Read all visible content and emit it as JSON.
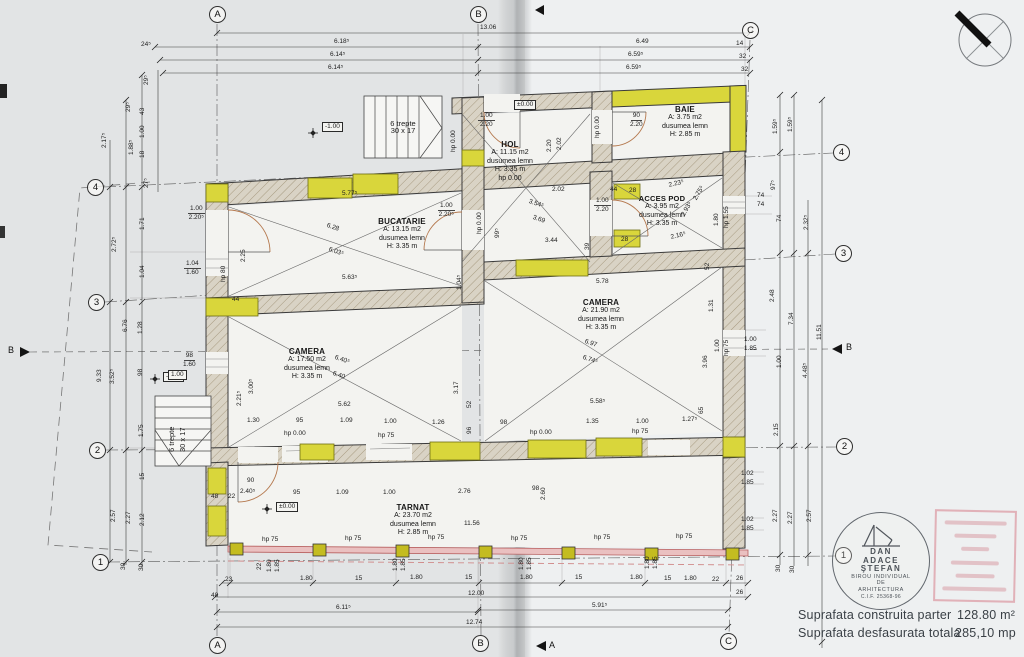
{
  "grid": {
    "a": "A",
    "b": "B",
    "c": "C",
    "n1": "1",
    "n2": "2",
    "n3": "3",
    "n4": "4"
  },
  "sections": {
    "a": "A",
    "b": "B"
  },
  "levels": {
    "minus": "-1.00"
  },
  "stairs": {
    "l1": "6 trepte",
    "l2": "30 x 17"
  },
  "rooms": {
    "bucatarie": {
      "name": "BUCATARIE",
      "area": "A: 13.15 m2",
      "floor": "dusumea lemn",
      "height": "H: 3.35 m"
    },
    "hol": {
      "name": "HOL",
      "area": "A: 11.15 m2",
      "floor": "dusumea lemn",
      "height": "H: 3.35 m",
      "hp": "hp 0.00"
    },
    "baie": {
      "name": "BAIE",
      "area": "A: 3.75 m2",
      "floor": "dusumea lemn",
      "height": "H: 2.85 m"
    },
    "acces_pod": {
      "name": "ACCES POD",
      "area": "A: 3.95 m2",
      "floor": "dusumea lemn",
      "height": "H: 3.35 m"
    },
    "camera1": {
      "name": "CAMERA",
      "area": "A: 17.50 m2",
      "floor": "dusumea lemn",
      "height": "H: 3.35 m"
    },
    "camera2": {
      "name": "CAMERA",
      "area": "A: 21.90 m2",
      "floor": "dusumea lemn",
      "height": "H: 3.35 m"
    },
    "tarnat": {
      "name": "TARNAT",
      "area": "A: 23.70 m2",
      "floor": "dusumea lemn",
      "height": "H: 2.85 m"
    }
  },
  "dims": {
    "top": [
      "13.06",
      "24⁵",
      "6.18⁵",
      "6.14⁵",
      "6.14⁵",
      "6.49",
      "14",
      "6.59⁵",
      "32",
      "6.59⁵",
      "32"
    ],
    "left": [
      "2.17⁵",
      "1.88⁵",
      "29⁵",
      "29⁵",
      "43",
      "1.00",
      "18",
      "27⁵",
      "1.71",
      "2.72⁵",
      "1.04",
      "6.76",
      "1.28",
      "9.33",
      "3.52⁵",
      "98",
      "1.75",
      "15",
      "2.57",
      "2.27",
      "2.12",
      "30",
      "30"
    ],
    "right": [
      "1.59⁵",
      "1.59⁵",
      "97⁵",
      "74",
      "74",
      "74",
      "2.32⁵",
      "2.48",
      "7.34",
      "11.51",
      "1.00",
      "1.85",
      "1.00",
      "4.48⁵",
      "2.15",
      "1.02",
      "1.85",
      "1.02",
      "1.85",
      "2.27",
      "2.27",
      "2.57",
      "30",
      "30",
      "1.80",
      "hp 1.55"
    ],
    "bottom": [
      "23",
      "1.80",
      "15",
      "1.80",
      "15",
      "1.80",
      "15",
      "1.80",
      "15",
      "1.80",
      "22",
      "26",
      "48",
      "12.00",
      "26",
      "6.11⁵",
      "5.91⁵",
      "12.74",
      "22",
      "1.80",
      "1.85",
      "1.80",
      "1.85",
      "1.80",
      "1.85",
      "1.80",
      "1.85"
    ]
  },
  "inner": {
    "buc": [
      "5.77⁵",
      "6.28",
      "6.03⁵",
      "5.63⁵",
      "2.25",
      "1.00",
      "2.20⁵",
      "hp 80",
      "1.04",
      "1.60",
      "1.00",
      "2.20⁵",
      "1.04⁵"
    ],
    "hol": [
      "±0.00",
      "1.00",
      "2.20",
      "hp 0.00",
      "2.20",
      "2.02",
      "2.02",
      "3.54⁵",
      "3.69",
      "3.44",
      "39",
      "hp 0.00",
      "99⁵",
      "1.00",
      "2.20",
      "44",
      "28",
      "28"
    ],
    "baie": [
      "90",
      "2.20",
      "hp 0.00"
    ],
    "ap": [
      "2.23⁵",
      "2.75⁵",
      "2.93⁵",
      "2.16⁵",
      "52"
    ],
    "c1": [
      "44",
      "98",
      "1.60",
      "1.00",
      "2.21⁵",
      "3.00⁵",
      "6.40⁵",
      "6.40",
      "5.62",
      "1.30",
      "95",
      "1.09",
      "1.00",
      "1.26",
      "hp 0.00",
      "hp 75",
      "3.17",
      "52",
      "96"
    ],
    "c2": [
      "5.78",
      "6.97",
      "6.74⁵",
      "5.58⁵",
      "98",
      "1.35",
      "1.00",
      "1.27⁵",
      "hp 0.00",
      "hp 75",
      "3.96",
      "1.31",
      "65",
      "1.00",
      "hp 75"
    ],
    "tar": [
      "11.56",
      "±0.00",
      "95",
      "1.09",
      "1.00",
      "2.76",
      "98",
      "2.60",
      "90",
      "2.40⁵",
      "48",
      "22",
      "hp 75",
      "hp 75",
      "hp 75",
      "hp 75",
      "hp 75",
      "hp 75"
    ]
  },
  "stamp": {
    "n1": "DAN",
    "n2": "ADACE",
    "n3": "ŞTEFAN",
    "o1": "BIROU INDIVIDUAL",
    "o2": "DE",
    "o3": "ARHITECTURA",
    "cif": "C.I.F. 25368-96"
  },
  "summary": {
    "l1": "Suprafata construita parter",
    "v1": "128.80 m²",
    "l2": "Suprafata desfasurata totala",
    "v2": "285,10 mp"
  }
}
